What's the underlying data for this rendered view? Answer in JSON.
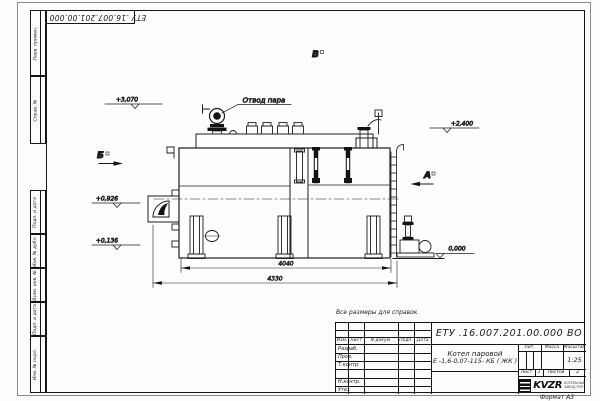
{
  "meta": {
    "format_label": "Формат А3"
  },
  "note": "Все размеры для справок",
  "frame": {
    "corner_code": "ЕТУ .16.007.201.00.000  ВО",
    "side_top": [
      "Перв. примен.",
      "Справ. №"
    ],
    "side_bottom": [
      "Подп. и дата",
      "Инв. № дубл.",
      "Взам. инв. №",
      "Подп. и дата",
      "Инв. № подл."
    ]
  },
  "drawing": {
    "callout_steam": "Отвод пара",
    "view_b": "Б",
    "view_a": "А",
    "view_v": "В",
    "elev_3070": "+3,070",
    "elev_0926": "+0,926",
    "elev_0136": "+0,136",
    "elev_2400": "+2,400",
    "elev_0000": "0,000",
    "dim_inner": "4040",
    "dim_outer": "4330"
  },
  "title_block": {
    "doc_number": "ЕТУ .16.007.201.00.000  ВО",
    "product_line1": "Котел паровой",
    "product_line2": "Е -1,6-0,07-115- КБ ( ЖК )",
    "col_izm": "Изм.",
    "col_list": "Лист",
    "col_ndoc": "N докум.",
    "col_podp": "Подп.",
    "col_data": "Дата",
    "row_razrab": "Разраб.",
    "row_prov": "Пров.",
    "row_tkontr": "Т.контр.",
    "row_nkontr": "Н.контр.",
    "row_utv": "Утв.",
    "lit_label": "Лит.",
    "mass_label": "Масса",
    "scale_label": "Масштаб",
    "scale_value": "1:25",
    "sheet_label": "Лист",
    "sheet_value": "1",
    "sheets_label": "Листов",
    "sheets_value": "2",
    "logo_text": "KVZR",
    "logo_sub1": "КОТЕЛЬНЫЙ",
    "logo_sub2": "ЗАВОД РЭП"
  }
}
